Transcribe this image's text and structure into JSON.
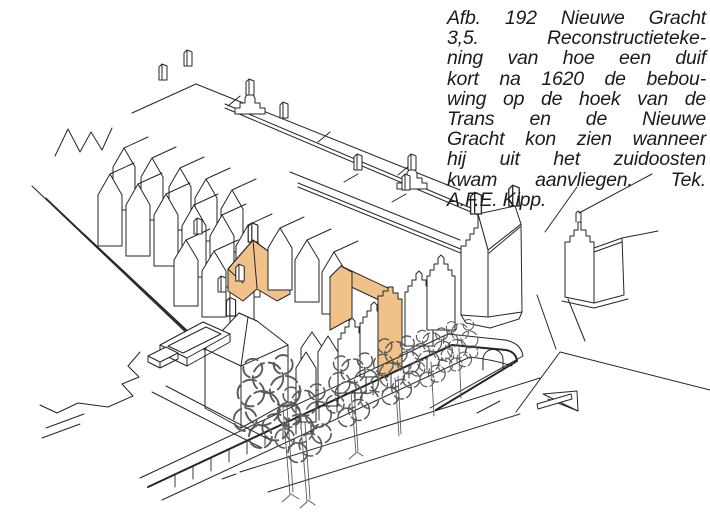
{
  "figure_caption": {
    "lines": [
      "Afb. 192 Nieuwe Gracht",
      "3,5. Reconstructieteke-",
      "ning van hoe een duif",
      "kort na 1620 de bebou-",
      "wing op de hoek van de",
      "Trans en de Nieuwe",
      "Gracht kon zien wanneer",
      "hij uit het zuidoosten",
      "kwam aanvliegen. Tek.",
      "A.F.E. Kipp."
    ],
    "full_text": "Afb. 192 Nieuwe Gracht 3,5. Reconstructietekening van hoe een duif kort na 1620 de bebouwing op de hoek van de Trans en de Nieuwe Gracht kon zien wanneer hij uit het zuidoosten kwam aanvliegen. Tek. A.F.E. Kipp."
  },
  "drawing": {
    "subject": "Reconstructie hoek Trans / Nieuwe Gracht, gezien uit het zuidoosten",
    "highlighted_address": "Nieuwe Gracht 3,5",
    "colors": {
      "ink": "#262626",
      "tree_ink": "#5a5a5a",
      "highlight": "#f0c28a",
      "paper": "#ffffff",
      "caption_text": "#1c1c1c"
    }
  }
}
